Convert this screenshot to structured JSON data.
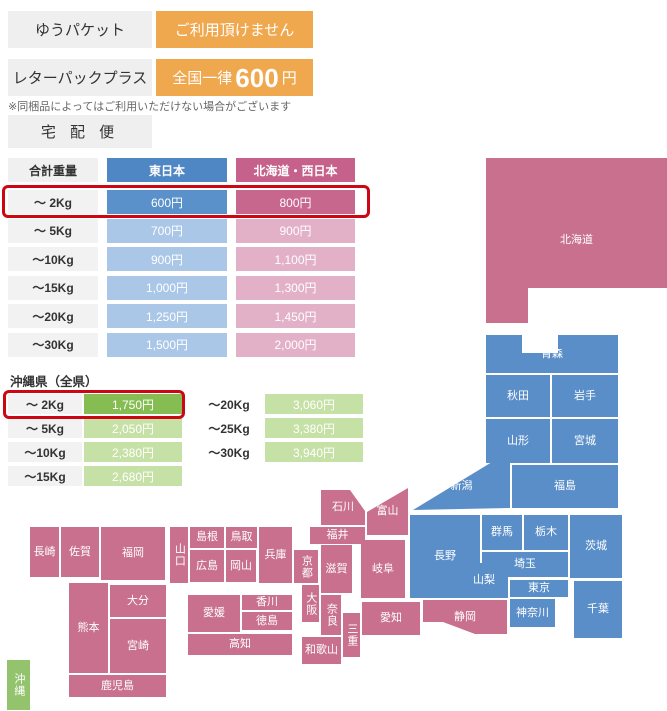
{
  "services": [
    {
      "name": "ゆうパケット",
      "value": "ご利用頂けません"
    },
    {
      "name": "レターパックプラス",
      "value_prefix": "全国一律",
      "value_amount": "600",
      "value_suffix": "円"
    }
  ],
  "note": "※同梱品によってはご利用いただけない場合がございます",
  "takuhaibin_label": "宅 配 便",
  "main_table": {
    "headers": [
      "合計重量",
      "東日本",
      "北海道・西日本"
    ],
    "rows": [
      {
        "weight": "〜 2Kg",
        "east": "600円",
        "west": "800円",
        "highlight": true
      },
      {
        "weight": "〜 5Kg",
        "east": "700円",
        "west": "900円"
      },
      {
        "weight": "〜10Kg",
        "east": "900円",
        "west": "1,100円"
      },
      {
        "weight": "〜15Kg",
        "east": "1,000円",
        "west": "1,300円"
      },
      {
        "weight": "〜20Kg",
        "east": "1,250円",
        "west": "1,450円"
      },
      {
        "weight": "〜30Kg",
        "east": "1,500円",
        "west": "2,000円"
      }
    ]
  },
  "okinawa_table": {
    "title": "沖縄県（全県）",
    "left_rows": [
      {
        "weight": "〜 2Kg",
        "price": "1,750円",
        "highlight": true
      },
      {
        "weight": "〜 5Kg",
        "price": "2,050円"
      },
      {
        "weight": "〜10Kg",
        "price": "2,380円"
      },
      {
        "weight": "〜15Kg",
        "price": "2,680円"
      }
    ],
    "right_rows": [
      {
        "weight": "〜20Kg",
        "price": "3,060円"
      },
      {
        "weight": "〜25Kg",
        "price": "3,380円"
      },
      {
        "weight": "〜30Kg",
        "price": "3,940円"
      }
    ]
  },
  "colors": {
    "orange": "#f0a84f",
    "highlight_red": "#cc0613",
    "east_header": "#4f87c5",
    "east_strong": "#5a91cb",
    "east_light": "#aac7e8",
    "west_header": "#c5618a",
    "west_strong": "#c8678e",
    "west_light": "#e3b1c7",
    "okinawa_strong": "#86bd52",
    "okinawa_light": "#c6e1a5",
    "map_east": "#5a8ec9",
    "map_west": "#c8708e",
    "map_okinawa": "#93c36c",
    "weight_cell_bg": "#f2f2f2",
    "box_gray": "#efefef"
  },
  "map": {
    "legend_east": "東日本",
    "legend_west": "北海道・西日本",
    "regions": [
      {
        "id": "hokkaido",
        "label": "北海道",
        "region": "west",
        "x": 486,
        "y": 158,
        "w": 181,
        "h": 165,
        "clip": "polygon(0px 0px, 181px 0px, 181px 130px, 42px 130px, 42px 165px, 0px 165px)"
      },
      {
        "id": "aomori",
        "label": "青森",
        "region": "east",
        "x": 486,
        "y": 335,
        "w": 132,
        "h": 38,
        "clip": "polygon(0px 0px, 36px 0px, 36px 18px, 72px 18px, 72px 0px, 132px 0px, 132px 38px, 0px 38px)"
      },
      {
        "id": "akita",
        "label": "秋田",
        "region": "east",
        "x": 486,
        "y": 375,
        "w": 64,
        "h": 42
      },
      {
        "id": "iwate",
        "label": "岩手",
        "region": "east",
        "x": 552,
        "y": 375,
        "w": 66,
        "h": 42
      },
      {
        "id": "yamagata",
        "label": "山形",
        "region": "east",
        "x": 486,
        "y": 419,
        "w": 64,
        "h": 44
      },
      {
        "id": "miyagi",
        "label": "宮城",
        "region": "east",
        "x": 552,
        "y": 419,
        "w": 66,
        "h": 44
      },
      {
        "id": "fukushima",
        "label": "福島",
        "region": "east",
        "x": 512,
        "y": 465,
        "w": 106,
        "h": 43
      },
      {
        "id": "niigata",
        "label": "新潟",
        "region": "east",
        "x": 413,
        "y": 462,
        "w": 97,
        "h": 48,
        "clip": "polygon(0px 48px, 79px 0px, 97px 0px, 97px 46px)"
      },
      {
        "id": "gunma",
        "label": "群馬",
        "region": "east",
        "x": 482,
        "y": 515,
        "w": 40,
        "h": 35
      },
      {
        "id": "tochigi",
        "label": "栃木",
        "region": "east",
        "x": 524,
        "y": 515,
        "w": 44,
        "h": 35
      },
      {
        "id": "ibaraki",
        "label": "茨城",
        "region": "east",
        "x": 570,
        "y": 515,
        "w": 52,
        "h": 63
      },
      {
        "id": "saitama",
        "label": "埼玉",
        "region": "east",
        "x": 482,
        "y": 552,
        "w": 86,
        "h": 25
      },
      {
        "id": "yamanashi",
        "label": "山梨",
        "region": "east",
        "x": 460,
        "y": 563,
        "w": 48,
        "h": 35
      },
      {
        "id": "tokyo",
        "label": "東京",
        "region": "east",
        "x": 510,
        "y": 580,
        "w": 58,
        "h": 17
      },
      {
        "id": "kanagawa",
        "label": "神奈川",
        "region": "east",
        "x": 510,
        "y": 599,
        "w": 45,
        "h": 28
      },
      {
        "id": "chiba",
        "label": "千葉",
        "region": "east",
        "x": 574,
        "y": 581,
        "w": 48,
        "h": 57
      },
      {
        "id": "nagano",
        "label": "長野",
        "region": "east",
        "x": 410,
        "y": 515,
        "w": 70,
        "h": 83,
        "clip": "polygon(0px 0px, 70px 0px, 70px 48px, 50px 48px, 50px 83px, 0px 83px)"
      },
      {
        "id": "toyama",
        "label": "富山",
        "region": "west",
        "x": 367,
        "y": 488,
        "w": 41,
        "h": 47,
        "clip": "polygon(0px 24px, 41px 0px, 41px 47px, 0px 47px)"
      },
      {
        "id": "ishikawa",
        "label": "石川",
        "region": "west",
        "x": 321,
        "y": 490,
        "w": 44,
        "h": 35,
        "clip": "polygon(0px 0px, 29px 0px, 44px 21px, 44px 35px, 0px 35px)"
      },
      {
        "id": "fukui",
        "label": "福井",
        "region": "west",
        "x": 310,
        "y": 527,
        "w": 55,
        "h": 17
      },
      {
        "id": "gifu",
        "label": "岐阜",
        "region": "west",
        "x": 361,
        "y": 540,
        "w": 44,
        "h": 58
      },
      {
        "id": "shizuoka",
        "label": "静岡",
        "region": "west",
        "x": 423,
        "y": 600,
        "w": 84,
        "h": 34,
        "clip": "polygon(0px 0px, 84px 0px, 84px 34px, 52px 34px, 20px 22px, 0px 22px)"
      },
      {
        "id": "aichi",
        "label": "愛知",
        "region": "west",
        "x": 362,
        "y": 602,
        "w": 58,
        "h": 33
      },
      {
        "id": "mie",
        "label": "三重",
        "region": "west",
        "x": 343,
        "y": 613,
        "w": 17,
        "h": 44,
        "vertical": true
      },
      {
        "id": "shiga",
        "label": "滋賀",
        "region": "west",
        "x": 321,
        "y": 545,
        "w": 31,
        "h": 48
      },
      {
        "id": "kyoto",
        "label": "京都",
        "region": "west",
        "x": 294,
        "y": 550,
        "w": 24,
        "h": 33,
        "vertical": true
      },
      {
        "id": "osaka",
        "label": "大阪",
        "region": "west",
        "x": 302,
        "y": 585,
        "w": 17,
        "h": 37,
        "vertical": true
      },
      {
        "id": "nara",
        "label": "奈良",
        "region": "west",
        "x": 321,
        "y": 595,
        "w": 20,
        "h": 40,
        "vertical": true
      },
      {
        "id": "wakayama",
        "label": "和歌山",
        "region": "west",
        "x": 302,
        "y": 637,
        "w": 39,
        "h": 27
      },
      {
        "id": "hyogo",
        "label": "兵庫",
        "region": "west",
        "x": 259,
        "y": 527,
        "w": 33,
        "h": 56
      },
      {
        "id": "tottori",
        "label": "鳥取",
        "region": "west",
        "x": 226,
        "y": 527,
        "w": 31,
        "h": 21
      },
      {
        "id": "okayama",
        "label": "岡山",
        "region": "west",
        "x": 226,
        "y": 550,
        "w": 30,
        "h": 32
      },
      {
        "id": "shimane",
        "label": "島根",
        "region": "west",
        "x": 190,
        "y": 527,
        "w": 34,
        "h": 21
      },
      {
        "id": "hiroshima",
        "label": "広島",
        "region": "west",
        "x": 190,
        "y": 550,
        "w": 34,
        "h": 32
      },
      {
        "id": "yamaguchi",
        "label": "山口",
        "region": "west",
        "x": 170,
        "y": 527,
        "w": 18,
        "h": 56,
        "vertical": true
      },
      {
        "id": "kagawa",
        "label": "香川",
        "region": "west",
        "x": 242,
        "y": 595,
        "w": 50,
        "h": 15
      },
      {
        "id": "tokushima",
        "label": "徳島",
        "region": "west",
        "x": 242,
        "y": 612,
        "w": 50,
        "h": 18
      },
      {
        "id": "ehime",
        "label": "愛媛",
        "region": "west",
        "x": 188,
        "y": 595,
        "w": 52,
        "h": 37
      },
      {
        "id": "kochi",
        "label": "高知",
        "region": "west",
        "x": 188,
        "y": 634,
        "w": 104,
        "h": 21
      },
      {
        "id": "fukuoka",
        "label": "福岡",
        "region": "west",
        "x": 101,
        "y": 527,
        "w": 64,
        "h": 53
      },
      {
        "id": "saga",
        "label": "佐賀",
        "region": "west",
        "x": 61,
        "y": 527,
        "w": 38,
        "h": 50
      },
      {
        "id": "nagasaki",
        "label": "長崎",
        "region": "west",
        "x": 30,
        "y": 527,
        "w": 29,
        "h": 50
      },
      {
        "id": "oita",
        "label": "大分",
        "region": "west",
        "x": 110,
        "y": 585,
        "w": 56,
        "h": 32
      },
      {
        "id": "kumamoto",
        "label": "熊本",
        "region": "west",
        "x": 69,
        "y": 583,
        "w": 39,
        "h": 90
      },
      {
        "id": "miyazaki",
        "label": "宮崎",
        "region": "west",
        "x": 110,
        "y": 619,
        "w": 56,
        "h": 54
      },
      {
        "id": "kagoshima",
        "label": "鹿児島",
        "region": "west",
        "x": 69,
        "y": 675,
        "w": 97,
        "h": 22
      },
      {
        "id": "okinawa",
        "label": "沖縄",
        "region": "okinawa",
        "x": 7,
        "y": 660,
        "w": 23,
        "h": 50,
        "vertical": true
      }
    ]
  }
}
